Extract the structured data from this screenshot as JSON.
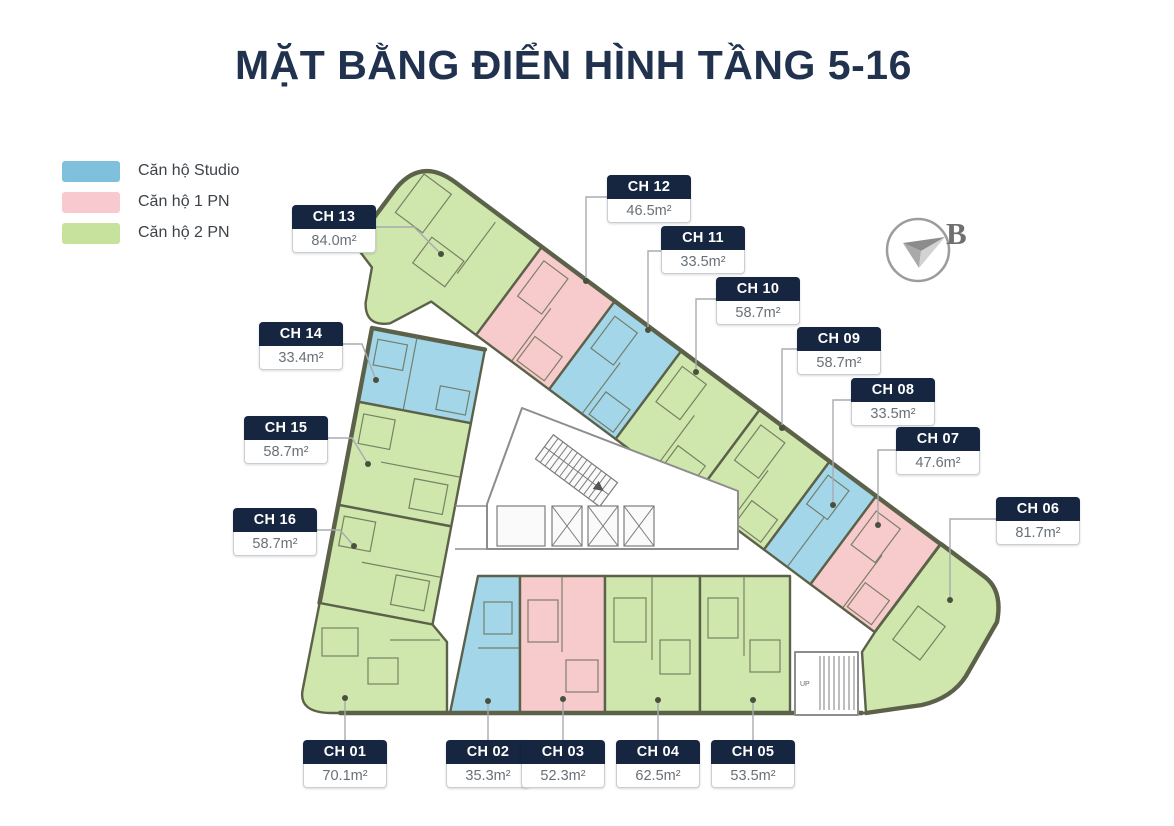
{
  "title": "MẶT BẰNG ĐIỂN HÌNH TẦNG 5-16",
  "legend": {
    "items": [
      {
        "label": "Căn hộ Studio",
        "color": "#7fc1dd",
        "key": "studio"
      },
      {
        "label": "Căn hộ 1 PN",
        "color": "#f8c9ce",
        "key": "1pn"
      },
      {
        "label": "Căn hộ 2 PN",
        "color": "#c6e29c",
        "key": "2pn"
      }
    ]
  },
  "compass": {
    "label": "B"
  },
  "core": {
    "up_label": "UP"
  },
  "units": [
    {
      "id": "CH 01",
      "area": "70.1m²",
      "type": "Căn hộ 2 PN"
    },
    {
      "id": "CH 02",
      "area": "35.3m²",
      "type": "Căn hộ Studio"
    },
    {
      "id": "CH 03",
      "area": "52.3m²",
      "type": "Căn hộ 1 PN"
    },
    {
      "id": "CH 04",
      "area": "62.5m²",
      "type": "Căn hộ 2 PN"
    },
    {
      "id": "CH 05",
      "area": "53.5m²",
      "type": "Căn hộ 2 PN"
    },
    {
      "id": "CH 06",
      "area": "81.7m²",
      "type": "Căn hộ 2 PN"
    },
    {
      "id": "CH 07",
      "area": "47.6m²",
      "type": "Căn hộ 1 PN"
    },
    {
      "id": "CH 08",
      "area": "33.5m²",
      "type": "Căn hộ Studio"
    },
    {
      "id": "CH 09",
      "area": "58.7m²",
      "type": "Căn hộ 2 PN"
    },
    {
      "id": "CH 10",
      "area": "58.7m²",
      "type": "Căn hộ 2 PN"
    },
    {
      "id": "CH 11",
      "area": "33.5m²",
      "type": "Căn hộ Studio"
    },
    {
      "id": "CH 12",
      "area": "46.5m²",
      "type": "Căn hộ 1 PN"
    },
    {
      "id": "CH 13",
      "area": "84.0m²",
      "type": "Căn hộ 2 PN"
    },
    {
      "id": "CH 14",
      "area": "33.4m²",
      "type": "Căn hộ Studio"
    },
    {
      "id": "CH 15",
      "area": "58.7m²",
      "type": "Căn hộ 2 PN"
    },
    {
      "id": "CH 16",
      "area": "58.7m²",
      "type": "Căn hộ 2 PN"
    }
  ],
  "colors": {
    "wall": "#5c6149",
    "studio_fill": "#a4d6e9",
    "one_pn_fill": "#f7cacc",
    "two_pn_fill": "#cfe6ad",
    "title": "#20324e",
    "label_header_bg": "#162540"
  }
}
